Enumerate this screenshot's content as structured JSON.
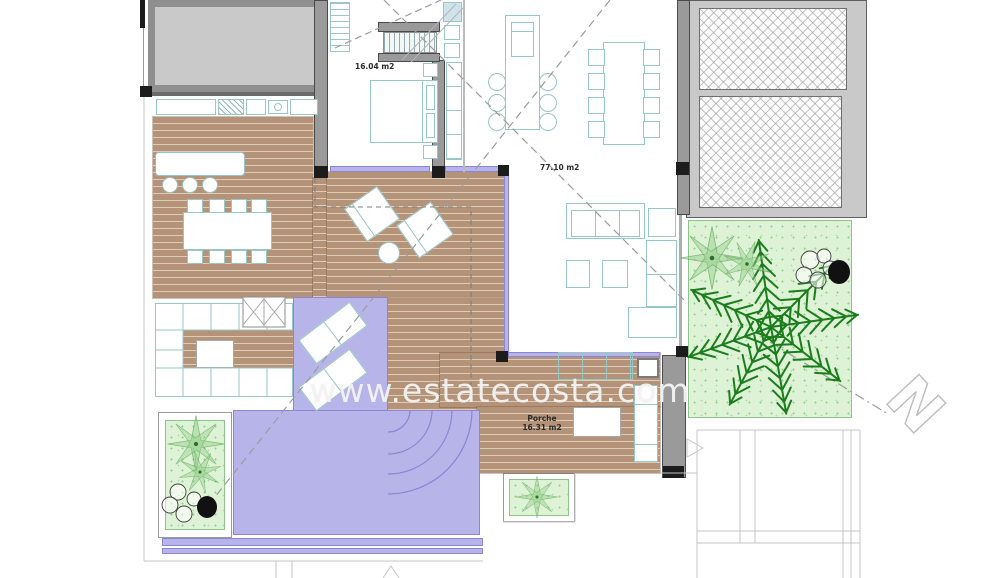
{
  "plan": {
    "watermark_text": "www.estatecosta.com",
    "north_label": "N",
    "labels": {
      "bedroom_area": "16.04 m2",
      "living_area": "77.10 m2",
      "porch_name": "Porche",
      "porch_area": "16.31 m2"
    },
    "legend": {
      "deck_color": "#b49379",
      "pool_color": "#b7b4ea",
      "pool_edge_color": "#8a86d2",
      "garden_color": "#def2d6",
      "wall_color": "#9a9a9a",
      "furniture_outline_color": "#97c6c6",
      "palm_color": "#1b7d1b",
      "watermark_color": "#f3f3f3"
    }
  }
}
